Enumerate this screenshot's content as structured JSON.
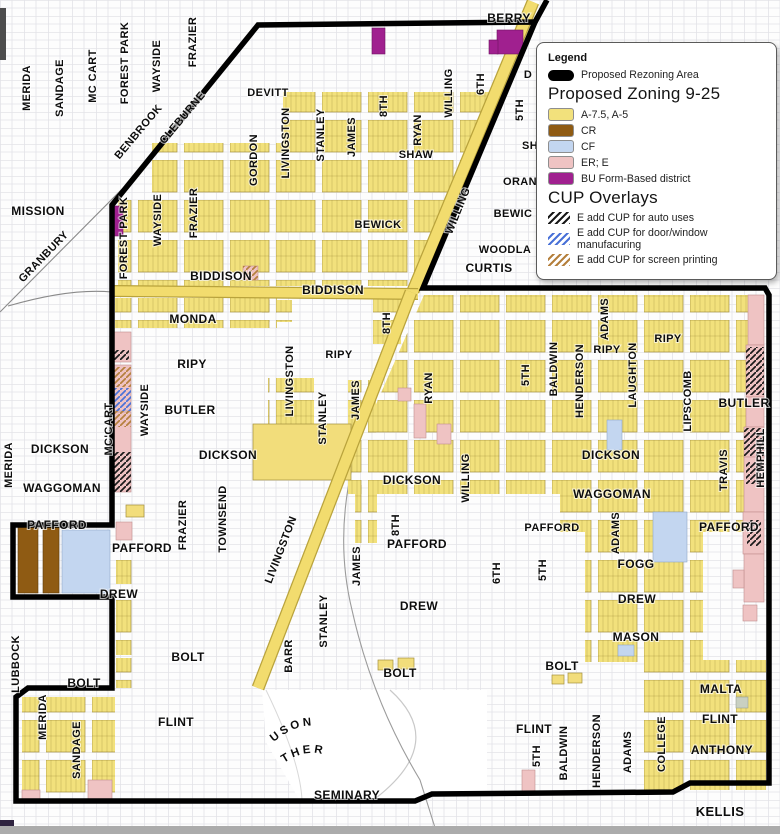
{
  "legend": {
    "title": "Legend",
    "rezoning": {
      "label": "Proposed Rezoning Area",
      "color": "#000000"
    },
    "zoning": {
      "heading": "Proposed Zoning 9-25",
      "items": [
        {
          "label": "A-7.5, A-5",
          "color": "#f2e17c"
        },
        {
          "label": "CR",
          "color": "#8f5b13"
        },
        {
          "label": "CF",
          "color": "#c3d6f0"
        },
        {
          "label": "ER; E",
          "color": "#efc3c3"
        },
        {
          "label": "BU Form-Based district",
          "color": "#a0208f"
        }
      ]
    },
    "overlays": {
      "heading": "CUP Overlays",
      "items": [
        {
          "label": "E add CUP for auto uses",
          "hatch_color": "#1a1a1a"
        },
        {
          "label": "E add CUP for door/window manufacuring",
          "hatch_color": "#4a72d8"
        },
        {
          "label": "E add CUP for screen printing",
          "hatch_color": "#b5803d"
        }
      ]
    }
  },
  "map": {
    "colors": {
      "boundary": "#000000",
      "parcel_yellow": "#f2e17c",
      "road_yellow": "#f2dc6e",
      "pink": "#efc3c3",
      "brown": "#8f5b13",
      "blue": "#c3d6f0",
      "purple": "#a0208f",
      "grid_line": "#e3e3e8"
    },
    "labels": [
      {
        "t": "MERIDA",
        "x": 30,
        "y": 88,
        "r": -90
      },
      {
        "t": "SANDAGE",
        "x": 63,
        "y": 88,
        "r": -90
      },
      {
        "t": "MC CART",
        "x": 96,
        "y": 76,
        "r": -90
      },
      {
        "t": "FOREST PARK",
        "x": 128,
        "y": 63,
        "r": -90
      },
      {
        "t": "WAYSIDE",
        "x": 160,
        "y": 66,
        "r": -90
      },
      {
        "t": "FRAZIER",
        "x": 196,
        "y": 42,
        "r": -90
      },
      {
        "t": "BENBROOK",
        "x": 141,
        "y": 134,
        "r": -50
      },
      {
        "t": "CLEBURNE",
        "x": 185,
        "y": 120,
        "r": -50
      },
      {
        "t": "MISSION",
        "x": 38,
        "y": 215,
        "r": 0,
        "s": 12
      },
      {
        "t": "GRANBURY",
        "x": 46,
        "y": 259,
        "r": -46
      },
      {
        "t": "BERRY",
        "x": 509,
        "y": 22,
        "r": 0,
        "s": 12
      },
      {
        "t": "DEVITT",
        "x": 268,
        "y": 96,
        "r": 0
      },
      {
        "t": "GORDON",
        "x": 257,
        "y": 160,
        "r": -90
      },
      {
        "t": "LIVINGSTON",
        "x": 289,
        "y": 143,
        "r": -90
      },
      {
        "t": "STANLEY",
        "x": 324,
        "y": 135,
        "r": -90
      },
      {
        "t": "JAMES",
        "x": 355,
        "y": 137,
        "r": -90
      },
      {
        "t": "8TH",
        "x": 387,
        "y": 106,
        "r": -90
      },
      {
        "t": "RYAN",
        "x": 421,
        "y": 130,
        "r": -90
      },
      {
        "t": "SHAW",
        "x": 416,
        "y": 158,
        "r": 0
      },
      {
        "t": "WILLING",
        "x": 452,
        "y": 93,
        "r": -90
      },
      {
        "t": "6TH",
        "x": 484,
        "y": 84,
        "r": -90
      },
      {
        "t": "5TH",
        "x": 523,
        "y": 110,
        "r": -90
      },
      {
        "t": "WILLING",
        "x": 461,
        "y": 212,
        "r": -68
      },
      {
        "t": "D",
        "x": 528,
        "y": 78,
        "r": 0
      },
      {
        "t": "SH",
        "x": 530,
        "y": 149,
        "r": 0
      },
      {
        "t": "ORAN",
        "x": 520,
        "y": 185,
        "r": 0
      },
      {
        "t": "BEWIC",
        "x": 513,
        "y": 217,
        "r": 0
      },
      {
        "t": "WOODLA",
        "x": 505,
        "y": 253,
        "r": 0
      },
      {
        "t": "CURTIS",
        "x": 489,
        "y": 272,
        "r": 0,
        "s": 12
      },
      {
        "t": "C",
        "x": 661,
        "y": 271,
        "r": -90
      },
      {
        "t": "BEWICK",
        "x": 378,
        "y": 228,
        "r": 0
      },
      {
        "t": "FOREST PARK",
        "x": 127,
        "y": 238,
        "r": -90
      },
      {
        "t": "WAYSIDE",
        "x": 161,
        "y": 220,
        "r": -90
      },
      {
        "t": "FRAZIER",
        "x": 197,
        "y": 213,
        "r": -90
      },
      {
        "t": "BIDDISON",
        "x": 221,
        "y": 280,
        "r": 0,
        "s": 12
      },
      {
        "t": "BIDDISON",
        "x": 333,
        "y": 294,
        "r": 0,
        "s": 12
      },
      {
        "t": "MONDA",
        "x": 193,
        "y": 323,
        "r": 0,
        "s": 12
      },
      {
        "t": "RIPY",
        "x": 192,
        "y": 368,
        "r": 0,
        "s": 12
      },
      {
        "t": "BUTLER",
        "x": 190,
        "y": 414,
        "r": 0,
        "s": 12
      },
      {
        "t": "WAYSIDE",
        "x": 148,
        "y": 410,
        "r": -90
      },
      {
        "t": "MC'CART",
        "x": 112,
        "y": 429,
        "r": -90
      },
      {
        "t": "LIVINGSTON",
        "x": 293,
        "y": 381,
        "r": -90
      },
      {
        "t": "STANLEY",
        "x": 326,
        "y": 418,
        "r": -90
      },
      {
        "t": "JAMES",
        "x": 359,
        "y": 400,
        "r": -90
      },
      {
        "t": "RIPY",
        "x": 339,
        "y": 358,
        "r": 0
      },
      {
        "t": "8TH",
        "x": 390,
        "y": 323,
        "r": -90
      },
      {
        "t": "RYAN",
        "x": 432,
        "y": 388,
        "r": -90
      },
      {
        "t": "5TH",
        "x": 529,
        "y": 375,
        "r": -90
      },
      {
        "t": "BALDWIN",
        "x": 557,
        "y": 369,
        "r": -90
      },
      {
        "t": "HENDERSON",
        "x": 583,
        "y": 381,
        "r": -90
      },
      {
        "t": "ADAMS",
        "x": 608,
        "y": 319,
        "r": -90
      },
      {
        "t": "RIPY",
        "x": 607,
        "y": 353,
        "r": 0
      },
      {
        "t": "LAUGHTON",
        "x": 636,
        "y": 375,
        "r": -90
      },
      {
        "t": "RIPY",
        "x": 668,
        "y": 342,
        "r": 0
      },
      {
        "t": "LIPSCOMB",
        "x": 691,
        "y": 401,
        "r": -90
      },
      {
        "t": "BUTLER",
        "x": 744,
        "y": 407,
        "r": 0,
        "s": 12
      },
      {
        "t": "HEMPHILL",
        "x": 764,
        "y": 458,
        "r": -90
      },
      {
        "t": "TRAVIS",
        "x": 727,
        "y": 470,
        "r": -90
      },
      {
        "t": "DICKSON",
        "x": 611,
        "y": 459,
        "r": 0,
        "s": 12
      },
      {
        "t": "WAGGOMAN",
        "x": 612,
        "y": 498,
        "r": 0,
        "s": 12
      },
      {
        "t": "DICKSON",
        "x": 60,
        "y": 453,
        "r": 0,
        "s": 12
      },
      {
        "t": "MERIDA",
        "x": 12,
        "y": 465,
        "r": -90
      },
      {
        "t": "WAGGOMAN",
        "x": 62,
        "y": 492,
        "r": 0,
        "s": 12
      },
      {
        "t": "DICKSON",
        "x": 228,
        "y": 459,
        "r": 0,
        "s": 12
      },
      {
        "t": "DICKSON",
        "x": 412,
        "y": 484,
        "r": 0,
        "s": 12
      },
      {
        "t": "WILLING",
        "x": 469,
        "y": 478,
        "r": -90
      },
      {
        "t": "TOWNSEND",
        "x": 226,
        "y": 519,
        "r": -90
      },
      {
        "t": "FRAZIER",
        "x": 186,
        "y": 525,
        "r": -90
      },
      {
        "t": "LIVINGSTON",
        "x": 284,
        "y": 551,
        "r": -69
      },
      {
        "t": "PAFFORD",
        "x": 57,
        "y": 529,
        "r": 0,
        "s": 12
      },
      {
        "t": "PAFFORD",
        "x": 142,
        "y": 552,
        "r": 0,
        "s": 12
      },
      {
        "t": "PAFFORD",
        "x": 417,
        "y": 548,
        "r": 0,
        "s": 12
      },
      {
        "t": "PAFFORD",
        "x": 552,
        "y": 531,
        "r": 0
      },
      {
        "t": "PAFFORD",
        "x": 729,
        "y": 531,
        "r": 0,
        "s": 12
      },
      {
        "t": "8TH",
        "x": 399,
        "y": 525,
        "r": -90
      },
      {
        "t": "JAMES",
        "x": 360,
        "y": 566,
        "r": -90
      },
      {
        "t": "6TH",
        "x": 500,
        "y": 573,
        "r": -90
      },
      {
        "t": "5TH",
        "x": 546,
        "y": 570,
        "r": -90
      },
      {
        "t": "ADAMS",
        "x": 619,
        "y": 533,
        "r": -90
      },
      {
        "t": "FOGG",
        "x": 636,
        "y": 568,
        "r": 0,
        "s": 12
      },
      {
        "t": "DREW",
        "x": 119,
        "y": 598,
        "r": 0,
        "s": 12
      },
      {
        "t": "DREW",
        "x": 419,
        "y": 610,
        "r": 0,
        "s": 12
      },
      {
        "t": "DREW",
        "x": 637,
        "y": 603,
        "r": 0,
        "s": 12
      },
      {
        "t": "MASON",
        "x": 636,
        "y": 641,
        "r": 0,
        "s": 12
      },
      {
        "t": "STANLEY",
        "x": 327,
        "y": 621,
        "r": -90
      },
      {
        "t": "BARR",
        "x": 292,
        "y": 656,
        "r": -90
      },
      {
        "t": "BOLT",
        "x": 84,
        "y": 687,
        "r": 0,
        "s": 12
      },
      {
        "t": "BOLT",
        "x": 188,
        "y": 661,
        "r": 0,
        "s": 12
      },
      {
        "t": "BOLT",
        "x": 400,
        "y": 677,
        "r": 0,
        "s": 12
      },
      {
        "t": "BOLT",
        "x": 562,
        "y": 670,
        "r": 0,
        "s": 12
      },
      {
        "t": "LUBBOCK",
        "x": 19,
        "y": 664,
        "r": -90
      },
      {
        "t": "MERIDA",
        "x": 46,
        "y": 717,
        "r": -90
      },
      {
        "t": "SANDAGE",
        "x": 80,
        "y": 750,
        "r": -90
      },
      {
        "t": "FLINT",
        "x": 176,
        "y": 726,
        "r": 0,
        "s": 12
      },
      {
        "t": "FLINT",
        "x": 534,
        "y": 733,
        "r": 0,
        "s": 12
      },
      {
        "t": "FLINT",
        "x": 720,
        "y": 723,
        "r": 0,
        "s": 12
      },
      {
        "t": "MALTA",
        "x": 721,
        "y": 693,
        "r": 0,
        "s": 12
      },
      {
        "t": "ANTHONY",
        "x": 722,
        "y": 754,
        "r": 0,
        "s": 12
      },
      {
        "t": "COLLEGE",
        "x": 665,
        "y": 744,
        "r": -90
      },
      {
        "t": "ADAMS",
        "x": 631,
        "y": 752,
        "r": -90
      },
      {
        "t": "HENDERSON",
        "x": 600,
        "y": 751,
        "r": -90
      },
      {
        "t": "BALDWIN",
        "x": 567,
        "y": 753,
        "r": -90
      },
      {
        "t": "5TH",
        "x": 540,
        "y": 756,
        "r": -90
      },
      {
        "t": "KELLIS",
        "x": 720,
        "y": 816,
        "r": 0,
        "s": 13
      },
      {
        "t": "SEMINARY",
        "x": 347,
        "y": 799,
        "r": 0,
        "s": 12
      }
    ],
    "curved_labels": [
      {
        "t": "FERGUSON",
        "d": "M274,742 Q316,706 358,748"
      },
      {
        "t": "J T LUTHER",
        "d": "M280,766 Q320,734 360,780"
      }
    ]
  }
}
